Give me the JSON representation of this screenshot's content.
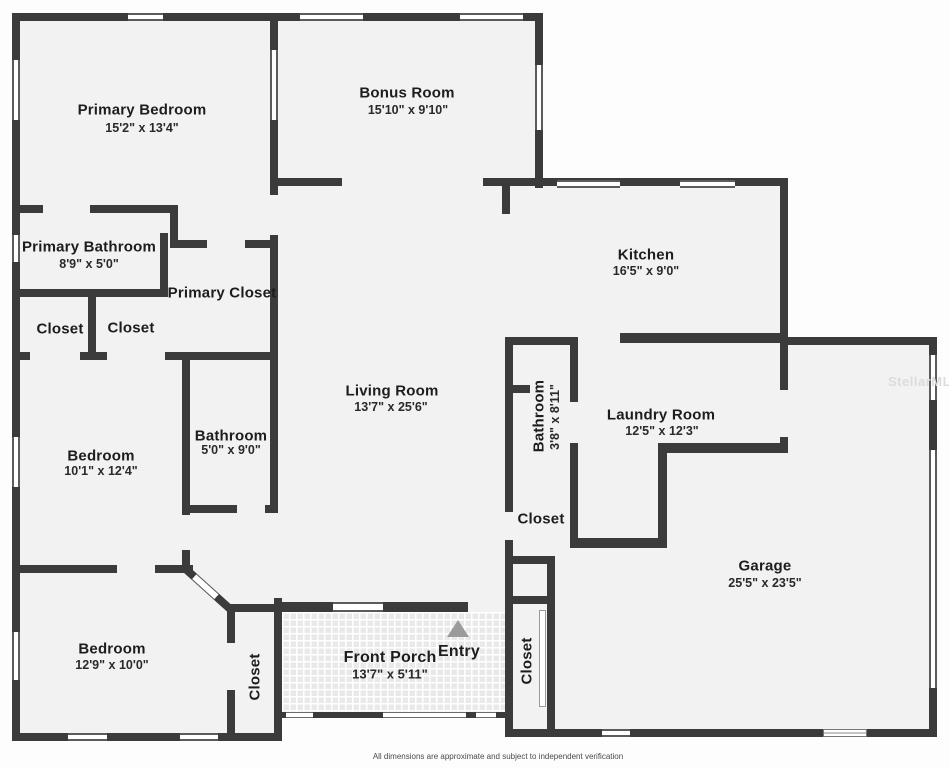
{
  "plan": {
    "rooms": [
      {
        "id": "primary-bedroom",
        "name": "Primary Bedroom",
        "dims": "15'2\" x 13'4\""
      },
      {
        "id": "bonus-room",
        "name": "Bonus Room",
        "dims": "15'10\" x 9'10\""
      },
      {
        "id": "kitchen",
        "name": "Kitchen",
        "dims": "16'5\" x 9'0\""
      },
      {
        "id": "primary-bathroom",
        "name": "Primary Bathroom",
        "dims": "8'9\" x 5'0\""
      },
      {
        "id": "primary-closet",
        "name": "Primary Closet"
      },
      {
        "id": "closet-1",
        "name": "Closet"
      },
      {
        "id": "closet-2",
        "name": "Closet"
      },
      {
        "id": "living-room",
        "name": "Living Room",
        "dims": "13'7\" x 25'6\""
      },
      {
        "id": "interior-bathroom",
        "name": "Bathroom",
        "dims": "3'8\" x 8'11\""
      },
      {
        "id": "laundry-room",
        "name": "Laundry Room",
        "dims": "12'5\" x 12'3\""
      },
      {
        "id": "hall-closet",
        "name": "Closet"
      },
      {
        "id": "bedroom-1",
        "name": "Bedroom",
        "dims": "10'1\" x 12'4\""
      },
      {
        "id": "bathroom-2",
        "name": "Bathroom",
        "dims": "5'0\" x 9'0\""
      },
      {
        "id": "garage",
        "name": "Garage",
        "dims": "25'5\" x 23'5\""
      },
      {
        "id": "bedroom-2",
        "name": "Bedroom",
        "dims": "12'9\" x 10'0\""
      },
      {
        "id": "bedroom-closet",
        "name": "Closet"
      },
      {
        "id": "front-porch",
        "name": "Front Porch",
        "dims": "13'7\" x 5'11\""
      },
      {
        "id": "entry",
        "name": "Entry"
      },
      {
        "id": "entry-closet",
        "name": "Closet"
      }
    ],
    "watermark": "StellarMLS",
    "disclaimer": "All dimensions are approximate and subject to independent verification",
    "colors": {
      "wall": "#3b3b3b",
      "floor": "#f2f2f2",
      "background": "#fdfdfd",
      "entry_arrow": "#9b9b9b",
      "watermark": "#dcdcdc"
    }
  }
}
